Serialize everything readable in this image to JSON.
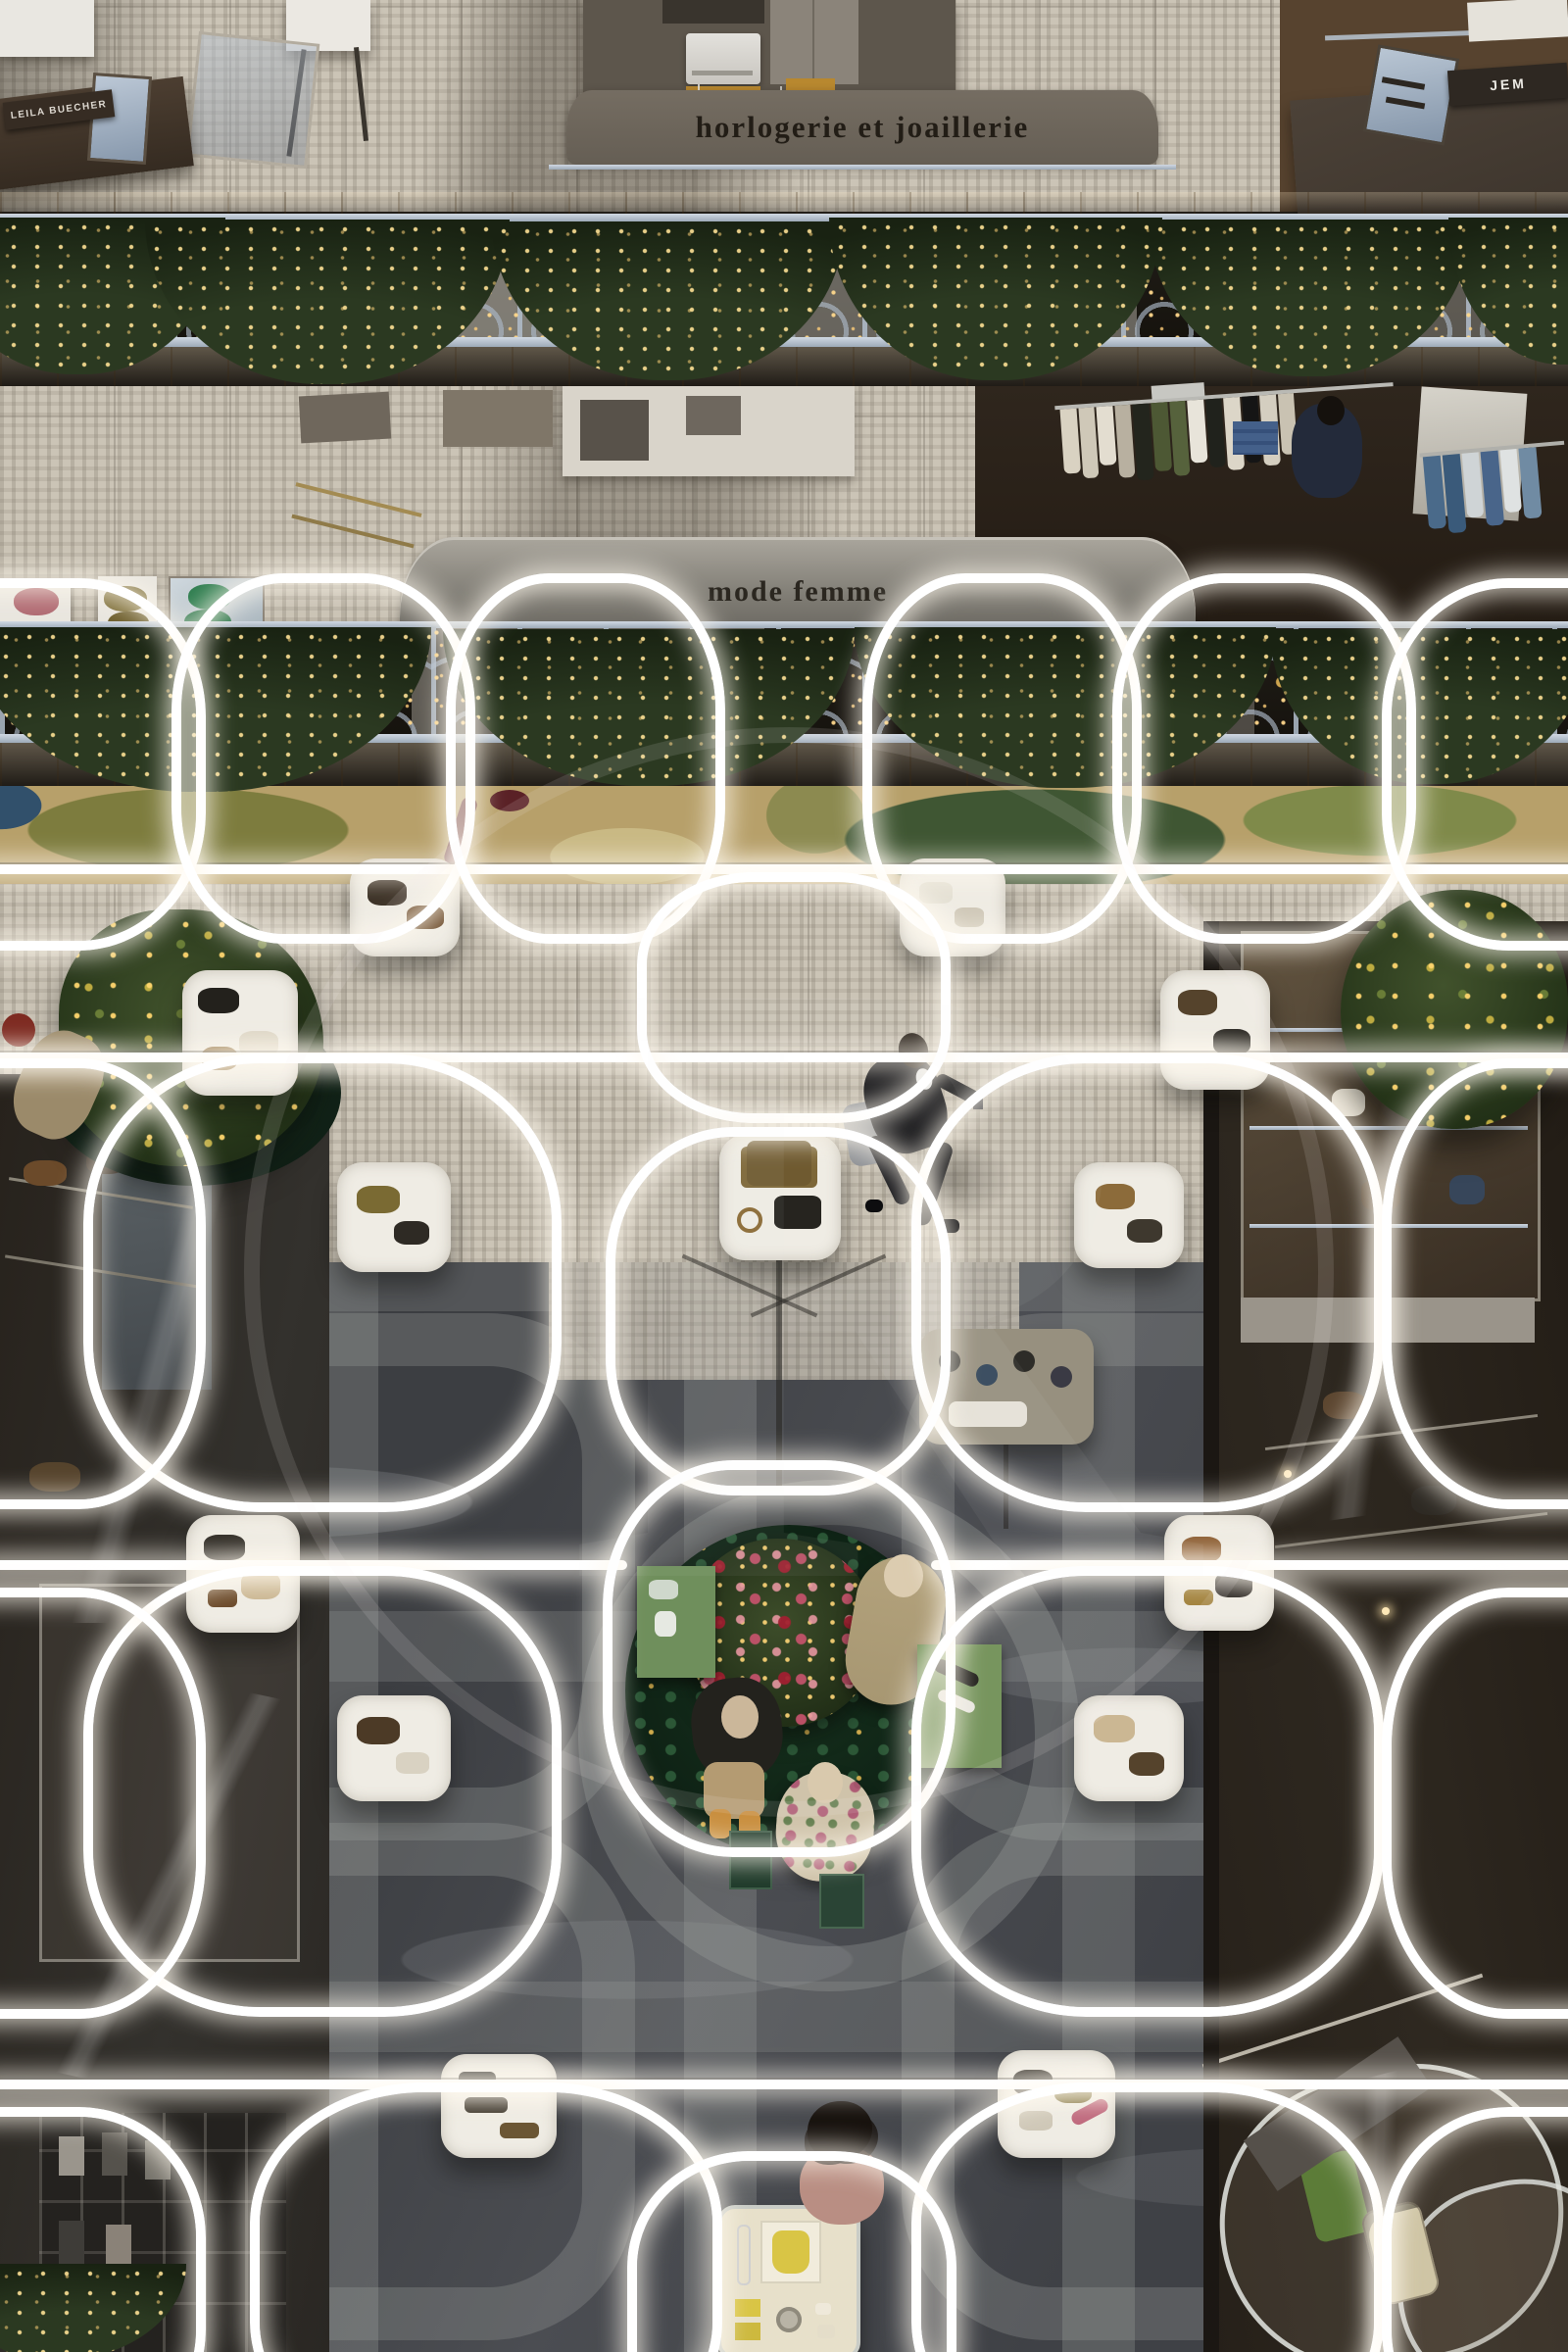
{
  "image": {
    "kind": "photograph",
    "subject": "Overhead view of a Parisian department store atrium at Christmas, looking down past balconies with garlands onto a leather-goods floor with a glowing rounded-square light lattice",
    "orientation": "portrait"
  },
  "signs": {
    "department_upper": "horlogerie et joaillerie",
    "department_middle": "mode femme",
    "brand_placard_left": "LEILA BUECHER",
    "brand_placard_right": "JEM"
  },
  "watermark": {
    "letter": "R"
  },
  "palette": {
    "floor_mosaic_beige": "#cbc4b6",
    "marble_grey": "#45474b",
    "lattice_white": "#ffffff",
    "garland_green": "#2b3921",
    "railing_pale_blue": "#b2bfce",
    "wood_rail": "#a9834f",
    "carpet_olive": "#7d7c3e",
    "carpet_tan": "#b7a06a",
    "tree_flower_red": "#b43a4e",
    "tree_gold_lights": "#ffd88c",
    "ornament_gold": "#cda44e"
  }
}
